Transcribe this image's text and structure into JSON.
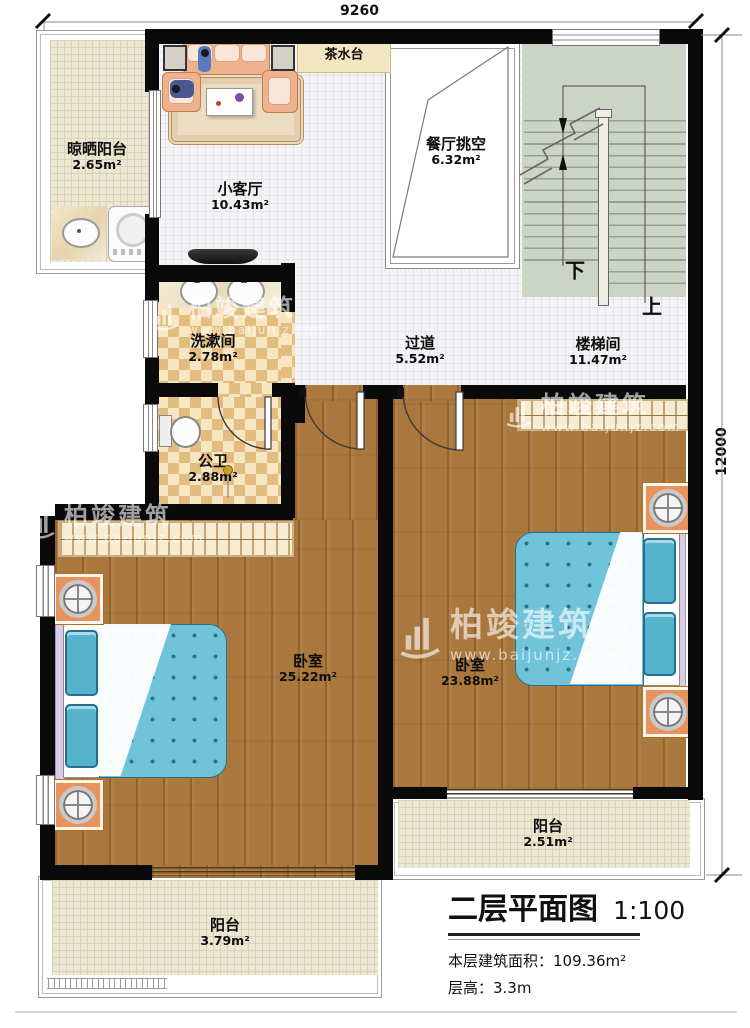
{
  "dimensions": {
    "top": "9260",
    "right": "12000"
  },
  "rooms": {
    "drying_balcony": {
      "name": "晾晒阳台",
      "area": "2.65m²"
    },
    "living": {
      "name": "小客厅",
      "area": "10.43m²"
    },
    "tea_station": {
      "name": "茶水台"
    },
    "dining_void": {
      "name": "餐厅挑空",
      "area": "6.32m²"
    },
    "stairwell": {
      "name": "楼梯间",
      "area": "11.47m²"
    },
    "washroom": {
      "name": "洗漱间",
      "area": "2.78m²"
    },
    "corridor": {
      "name": "过道",
      "area": "5.52m²"
    },
    "toilet": {
      "name": "公卫",
      "area": "2.88m²"
    },
    "bedroom_left": {
      "name": "卧室",
      "area": "25.22m²"
    },
    "bedroom_right": {
      "name": "卧室",
      "area": "23.88m²"
    },
    "balcony_right": {
      "name": "阳台",
      "area": "2.51m²"
    },
    "balcony_left": {
      "name": "阳台",
      "area": "3.79m²"
    }
  },
  "stairs": {
    "down_label": "下",
    "up_label": "上"
  },
  "title_block": {
    "title": "二层平面图",
    "scale": "1:100",
    "floor_area": "本层建筑面积：109.36m²",
    "floor_height": "层高：3.3m"
  },
  "watermark": {
    "brand": "柏竣建筑",
    "url": "www.baijunjz.com"
  },
  "colors": {
    "wall": "#0a0a0a",
    "wood": "#aa783d",
    "bath_tile": "#e3bd80",
    "stair": "#ccd4c6",
    "bed": "#70c4da",
    "balcony": "#ece7d3"
  }
}
